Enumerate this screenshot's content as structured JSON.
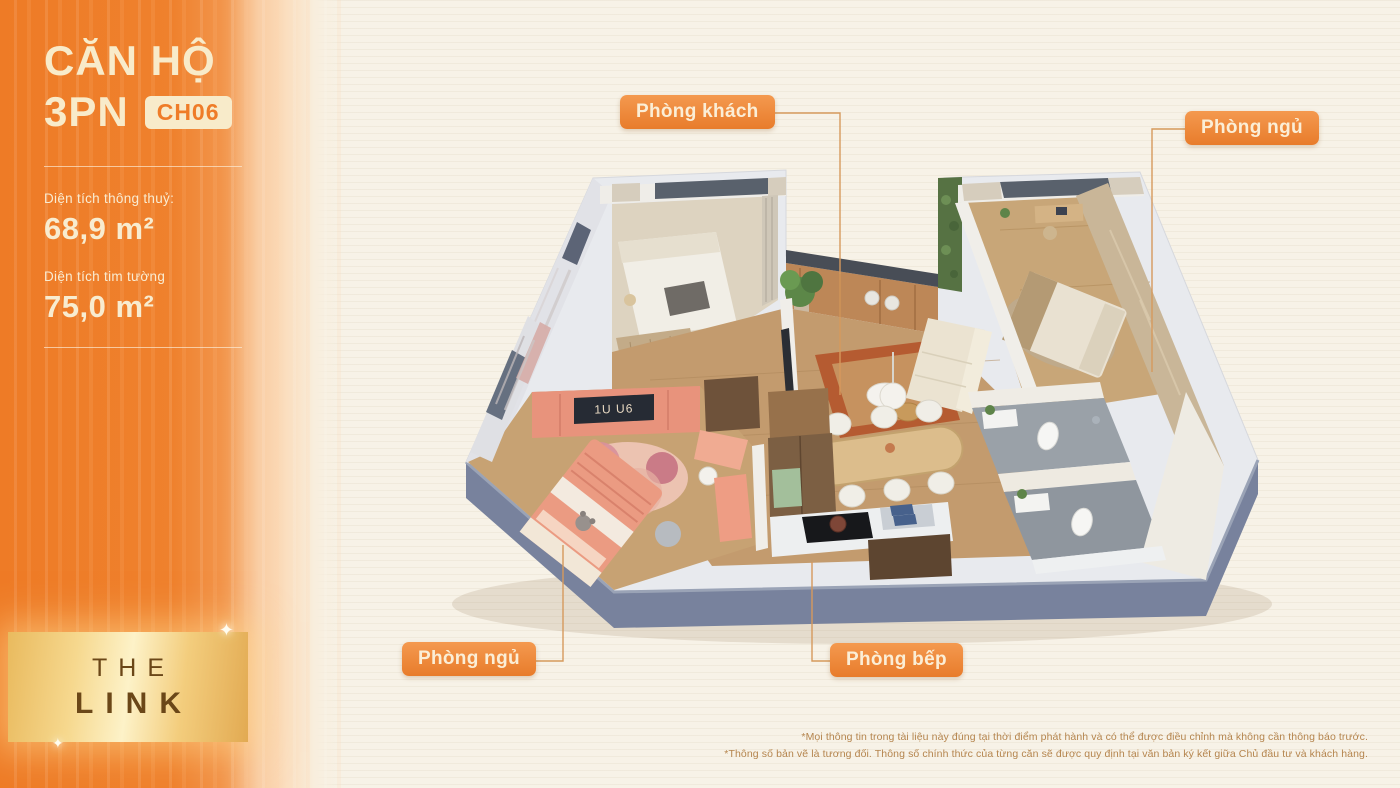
{
  "sidebar": {
    "title": "CĂN HỘ",
    "subtitle": "3PN",
    "unit_badge": "CH06",
    "area1_label": "Diện tích thông thuỷ:",
    "area1_value": "68,9 m²",
    "area2_label": "Diện tích tim tường",
    "area2_value": "75,0 m²",
    "logo_line1": "THE",
    "logo_line2": "LINK"
  },
  "floorplan": {
    "labels": [
      {
        "text": "Phòng khách",
        "position": "top-center"
      },
      {
        "text": "Phòng ngủ",
        "position": "top-right"
      },
      {
        "text": "Phòng ngủ",
        "position": "bottom-left"
      },
      {
        "text": "Phòng bếp",
        "position": "bottom-center"
      }
    ],
    "wardrobe_sign": "1U U6"
  },
  "footnote": {
    "line1": "*Mọi thông tin trong tài liệu này đúng tại thời điểm phát hành và có thể được điều chỉnh mà không cần thông báo trước.",
    "line2": "*Thông số bản vẽ là tương đối. Thông số chính thức của từng căn sẽ được quy định tại văn bản ký kết giữa Chủ đầu tư và khách hàng."
  },
  "colors": {
    "accent_orange": "#ee7b26",
    "label_background": "#ed8636",
    "label_text": "#fbeed6",
    "cream_background": "#f7f2e7",
    "wall_slate": "#78829d",
    "leader_line": "#d6995c",
    "gold_banner": "#f6d88e"
  }
}
